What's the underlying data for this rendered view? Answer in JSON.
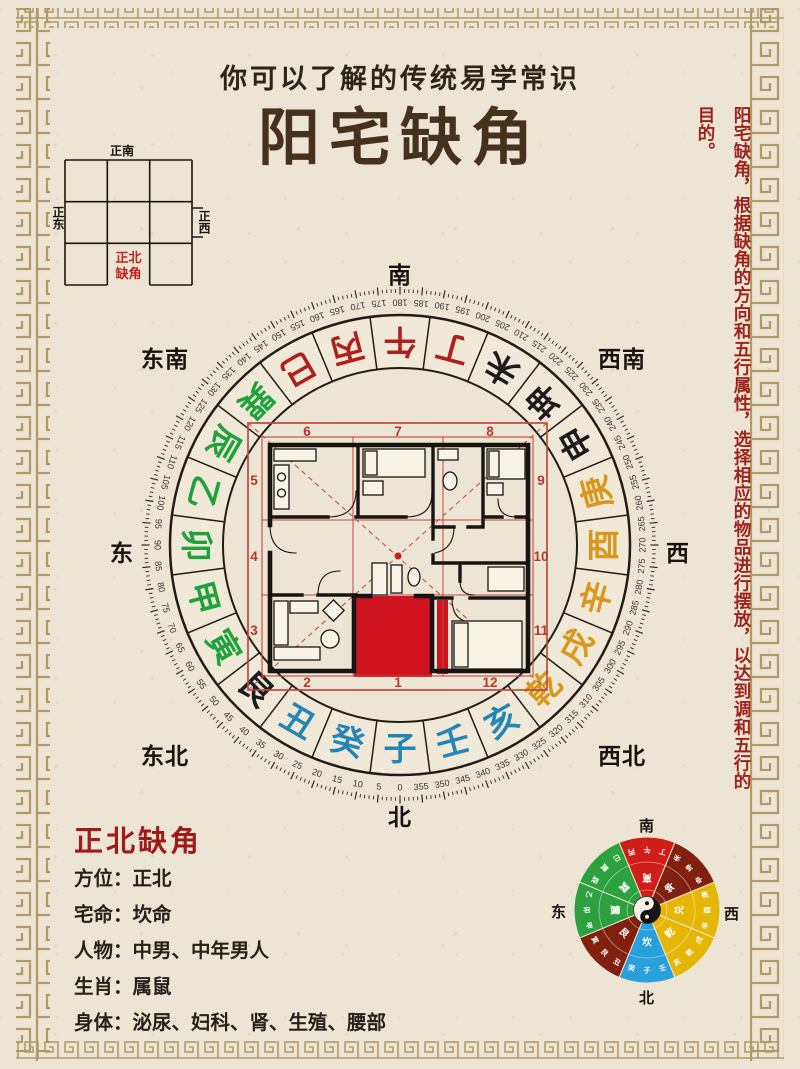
{
  "header": {
    "subtitle": "你可以了解的传统易学常识",
    "title": "阳宅缺角"
  },
  "corner_diagram": {
    "top": "正南",
    "left": "正东",
    "right": "正西",
    "missing_line1": "正北",
    "missing_line2": "缺角"
  },
  "side_note": "阳宅缺角，根据缺角的方向和五行属性，选择相应的物品进行摆放，以达到调和五行的目的。",
  "compass": {
    "direction_labels": {
      "top": "南",
      "bottom": "北",
      "left": "东",
      "right": "西",
      "top_left": "东南",
      "top_right": "西南",
      "bottom_left": "东北",
      "bottom_right": "西北"
    },
    "mountains": [
      {
        "ch": "子",
        "deg": 0,
        "color": "#2585b5"
      },
      {
        "ch": "癸",
        "deg": 15,
        "color": "#2585b5"
      },
      {
        "ch": "丑",
        "deg": 30,
        "color": "#2585b5"
      },
      {
        "ch": "艮",
        "deg": 45,
        "color": "#1b1b1b"
      },
      {
        "ch": "寅",
        "deg": 60,
        "color": "#1fa23c"
      },
      {
        "ch": "甲",
        "deg": 75,
        "color": "#1fa23c"
      },
      {
        "ch": "卯",
        "deg": 90,
        "color": "#1fa23c"
      },
      {
        "ch": "乙",
        "deg": 105,
        "color": "#1fa23c"
      },
      {
        "ch": "辰",
        "deg": 120,
        "color": "#1fa23c"
      },
      {
        "ch": "巽",
        "deg": 135,
        "color": "#1fa23c"
      },
      {
        "ch": "巳",
        "deg": 150,
        "color": "#b01f1c"
      },
      {
        "ch": "丙",
        "deg": 165,
        "color": "#b01f1c"
      },
      {
        "ch": "午",
        "deg": 180,
        "color": "#b01f1c"
      },
      {
        "ch": "丁",
        "deg": 195,
        "color": "#b01f1c"
      },
      {
        "ch": "未",
        "deg": 210,
        "color": "#1b1b1b"
      },
      {
        "ch": "坤",
        "deg": 225,
        "color": "#1b1b1b"
      },
      {
        "ch": "申",
        "deg": 240,
        "color": "#1b1b1b"
      },
      {
        "ch": "庚",
        "deg": 255,
        "color": "#d9971e"
      },
      {
        "ch": "酉",
        "deg": 270,
        "color": "#d9971e"
      },
      {
        "ch": "辛",
        "deg": 285,
        "color": "#d9971e"
      },
      {
        "ch": "戌",
        "deg": 300,
        "color": "#d9971e"
      },
      {
        "ch": "乾",
        "deg": 315,
        "color": "#d9971e"
      },
      {
        "ch": "亥",
        "deg": 330,
        "color": "#2585b5"
      },
      {
        "ch": "壬",
        "deg": 345,
        "color": "#2585b5"
      }
    ],
    "degree_labels": [
      0,
      5,
      10,
      15,
      20,
      25,
      30,
      35,
      40,
      45,
      50,
      55,
      60,
      65,
      70,
      75,
      80,
      85,
      90,
      95,
      100,
      105,
      110,
      115,
      120,
      125,
      130,
      135,
      140,
      145,
      150,
      155,
      160,
      165,
      170,
      175,
      180,
      185,
      190,
      195,
      200,
      205,
      210,
      215,
      220,
      225,
      230,
      235,
      240,
      245,
      250,
      255,
      260,
      265,
      270,
      275,
      280,
      285,
      290,
      295,
      300,
      305,
      310,
      315,
      320,
      325,
      330,
      335,
      340,
      345,
      350,
      355
    ],
    "palace_numbers": [
      "1",
      "2",
      "3",
      "4",
      "5",
      "6",
      "7",
      "8",
      "9",
      "10",
      "11",
      "12"
    ]
  },
  "info_panel": {
    "heading": "正北缺角",
    "rows": [
      "方位：正北",
      "宅命：坎命",
      "人物：中男、中年男人",
      "生肖：属鼠",
      "身体：泌尿、妇科、肾、生殖、腰部"
    ]
  },
  "mini_compass": {
    "labels": {
      "top": "南",
      "bottom": "北",
      "left": "东",
      "right": "西"
    },
    "sectors": [
      {
        "trigram": "离",
        "deg": 180,
        "color": "#cf1d18"
      },
      {
        "trigram": "坤",
        "deg": 225,
        "color": "#82200f"
      },
      {
        "trigram": "兑",
        "deg": 270,
        "color": "#e5b607"
      },
      {
        "trigram": "乾",
        "deg": 315,
        "color": "#e5b607"
      },
      {
        "trigram": "坎",
        "deg": 0,
        "color": "#29a0dc"
      },
      {
        "trigram": "艮",
        "deg": 45,
        "color": "#82200f"
      },
      {
        "trigram": "震",
        "deg": 90,
        "color": "#2ca13d"
      },
      {
        "trigram": "巽",
        "deg": 135,
        "color": "#2ca13d"
      }
    ]
  },
  "colors": {
    "paper": "#ece5d4",
    "ink": "#221c13",
    "border_tan": "#b29a68",
    "accent_red": "#9e221e",
    "highlight_red": "#cf1320",
    "frame_red": "#c0473b",
    "wood_green": "#1fa23c",
    "fire_red": "#b01f1c",
    "metal_gold": "#d9971e",
    "water_blue": "#2585b5",
    "earth_black": "#1b1b1b"
  }
}
